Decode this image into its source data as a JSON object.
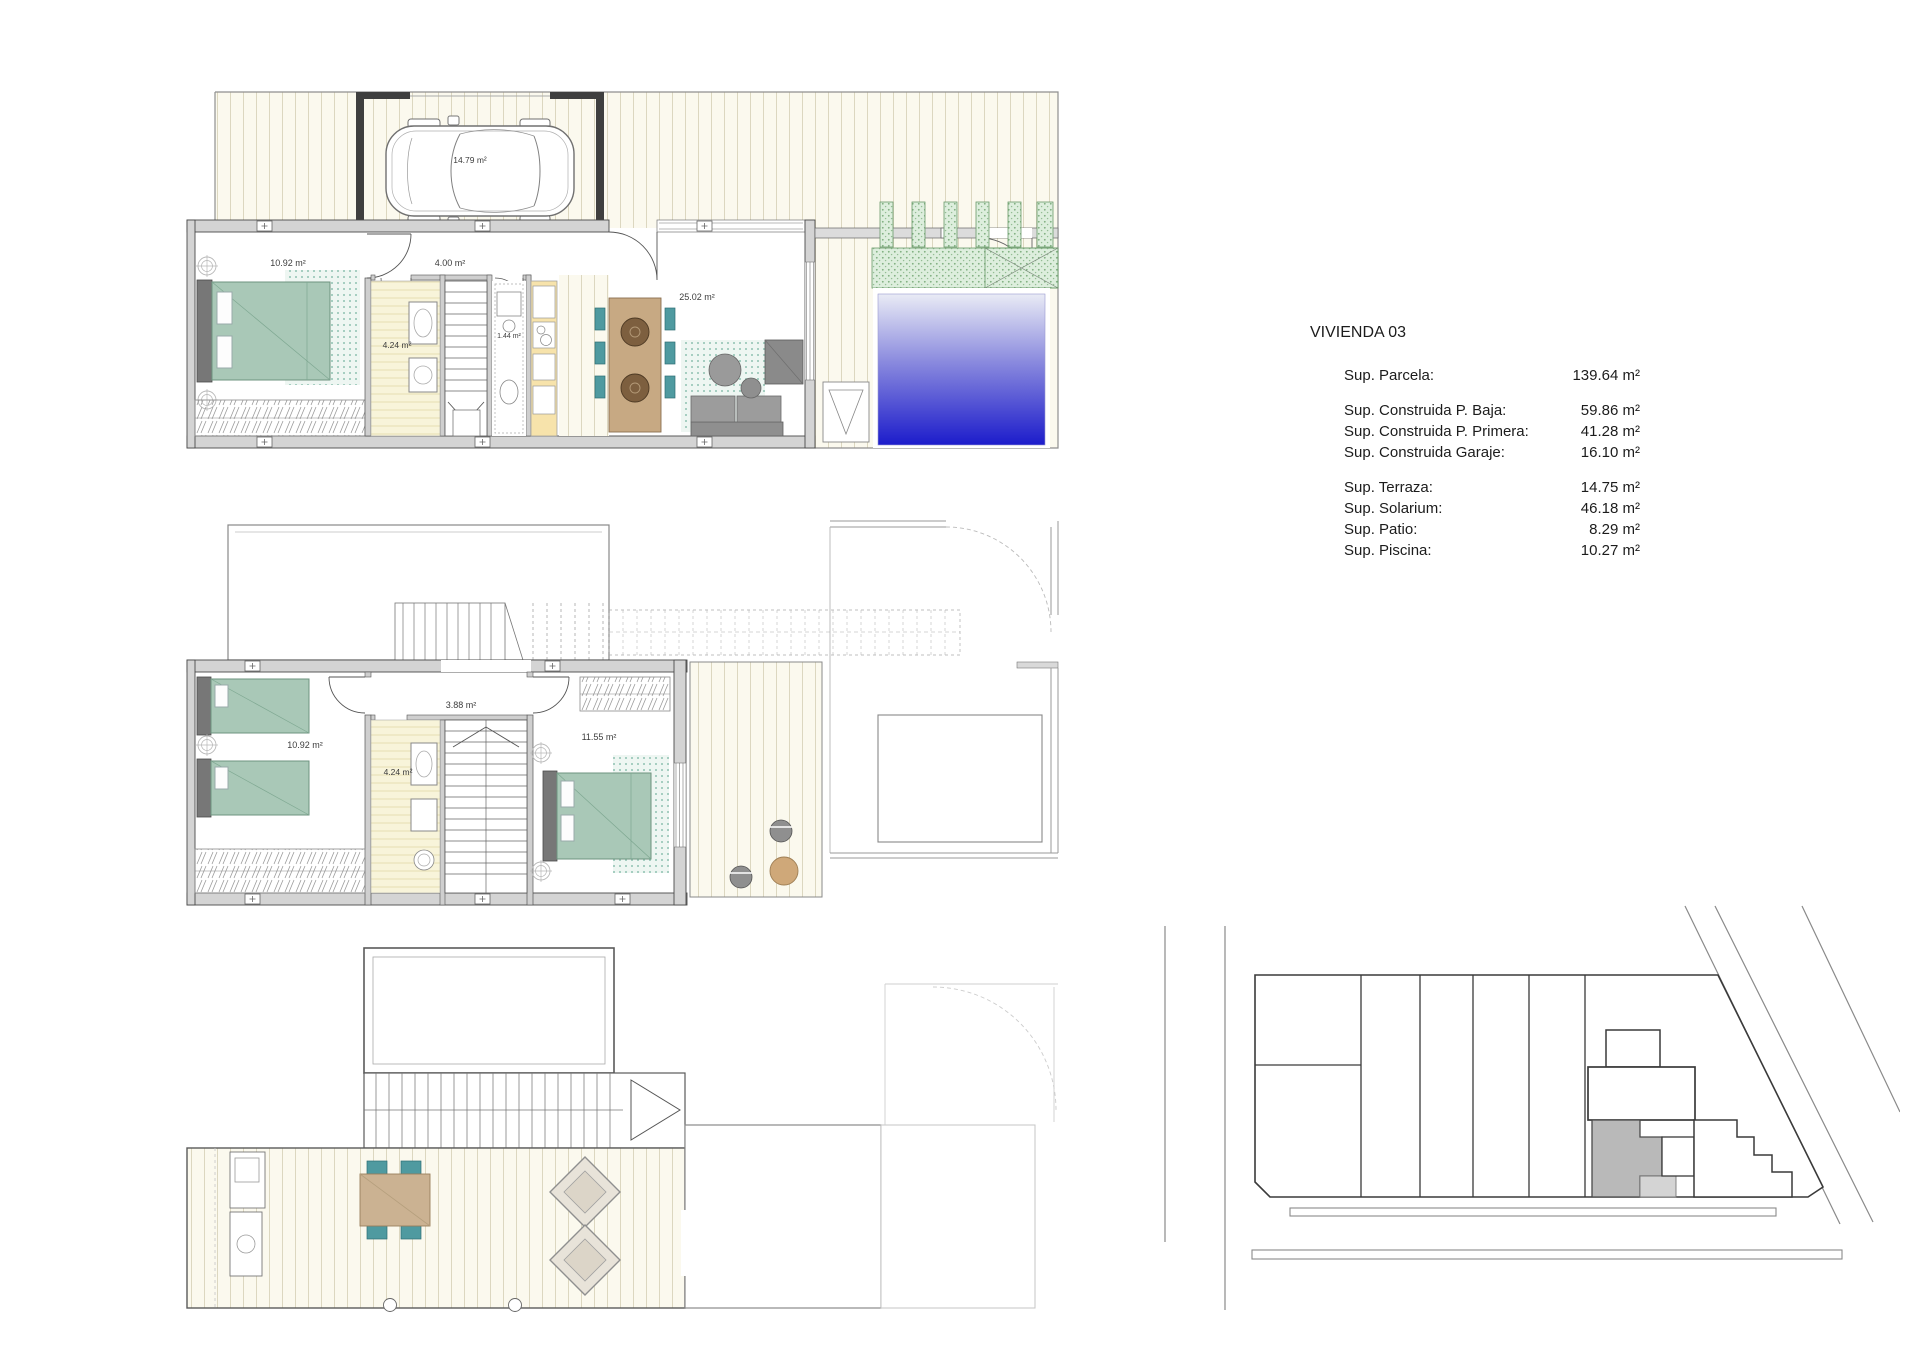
{
  "info_panel": {
    "title": "VIVIENDA 03",
    "rows": [
      {
        "label": "Sup. Parcela:",
        "value": "139.64 m²"
      },
      {
        "label": "Sup. Construida P. Baja:",
        "value": "59.86 m²"
      },
      {
        "label": "Sup. Construida P. Primera:",
        "value": "41.28 m²"
      },
      {
        "label": "Sup. Construida Garaje:",
        "value": "16.10 m²"
      },
      {
        "label": "Sup. Terraza:",
        "value": "14.75 m²"
      },
      {
        "label": "Sup. Solarium:",
        "value": "46.18 m²"
      },
      {
        "label": "Sup. Patio:",
        "value": "8.29 m²"
      },
      {
        "label": "Sup. Piscina:",
        "value": "10.27 m²"
      }
    ]
  },
  "plans": {
    "ground": {
      "labels": {
        "garage": "14.79 m²",
        "bedroom": "10.92 m²",
        "hall": "4.00 m²",
        "bathroom": "4.24 m²",
        "wc": "1.44 m²",
        "living": "25.02 m²"
      }
    },
    "first": {
      "labels": {
        "bedroom_left": "10.92 m²",
        "hall": "3.88 m²",
        "bathroom": "4.24 m²",
        "bedroom_right": "11.55 m²"
      }
    }
  },
  "colors": {
    "pool_top": "#e9ebf5",
    "pool_bottom": "#1c1ccb",
    "bed_green": "#a9c8b7",
    "chair_teal": "#4f9aa0",
    "table_wood": "#c7a983",
    "vegetation": "#ddeedd",
    "deck_floor": "#fbf9ee",
    "bath_floor": "#f8f4da",
    "kitchen_counter": "#f7e3ab",
    "wall_fill": "#d4d4d4",
    "site_highlight": "#b9b9b9"
  }
}
